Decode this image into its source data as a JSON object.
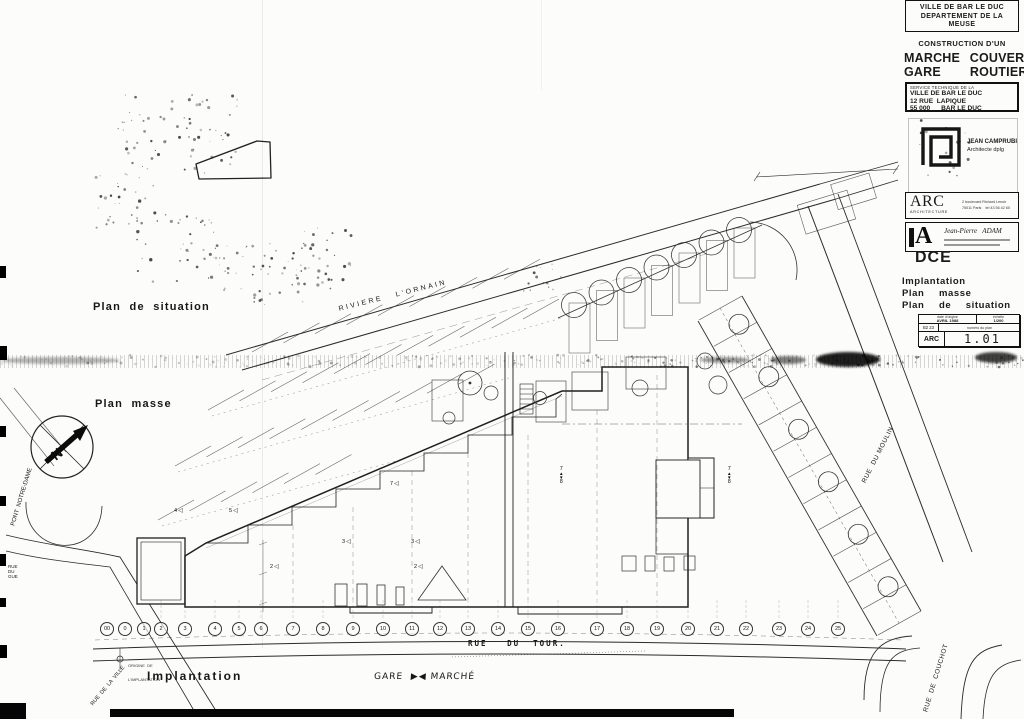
{
  "sheet_title_block": {
    "client_box": {
      "line1": "VILLE DE BAR LE DUC",
      "line2": "DEPARTEMENT DE LA",
      "line3": "MEUSE"
    },
    "construction_label": "CONSTRUCTION D'UN",
    "project_line1": "MARCHE COUVERT",
    "project_line2": "GARE   ROUTIERE",
    "service_box": {
      "line1": "SERVICE TECHNIQUE DE LA",
      "line2": "VILLE DE BAR LE DUC",
      "line3": "12 RUE  LAPIQUE",
      "line4": "55 000      BAR LE DUC"
    },
    "architect": {
      "name": "JEAN CAMPRUBI",
      "title": "Architecte  dplg",
      "addr1": "11 rue des Epargnes",
      "addr2": "55 160  Fresnes en Woevre",
      "addr3": "1 29 1 87 33 43"
    },
    "arc_agency": {
      "name": "ARC",
      "subtitle": "ARCHITECTURE",
      "addr1": "2 boulevard Richard Lenoir",
      "addr2": "75011 Paris    tel 43 56 42 60"
    },
    "adam_agency": {
      "logo_letter": "A",
      "name": "Jean-Pierre   ADAM"
    },
    "phase": "DCE",
    "content_title1": "Implantation",
    "content_title2": "Plan  masse",
    "content_title3": "Plan  de  situation",
    "info_table": {
      "date_label": "date d'origine",
      "date_value": "AVRIL 1988",
      "scale_label": "échelle",
      "scale_value": "1/200",
      "code": "B2 23",
      "number_label": "numéro du plan",
      "agency": "ARC",
      "plan_number": "1.01"
    }
  },
  "plan_labels": {
    "situation": "Plan  de  situation",
    "masse": "Plan  masse",
    "implantation": "Implantation",
    "gare_marche": "GARE  ▶◀ MARCHÉ",
    "origin_line1": "ORIGINE  DE",
    "origin_line2": "L'IMPLANTATION"
  },
  "streets": {
    "ornain": "RIVIERE   L'ORNAIN",
    "moulin": "RUE  DU MOULIN",
    "couchot": "RUE  DE  COUCHOT",
    "pont_notre_dame": "PONT  NOTRE-DAME",
    "rue_ville": "RUE  DE  LA  VILLE",
    "rue_gue": "RUE DU GUE",
    "rue_tour": "RUE   DU  TOUR."
  },
  "compass_letter": "N",
  "grid_markers": {
    "labels": [
      "00",
      "0",
      "1",
      "2",
      "3",
      "4",
      "5",
      "6",
      "7",
      "8",
      "9",
      "10",
      "11",
      "12",
      "13",
      "14",
      "15",
      "16",
      "17",
      "18",
      "19",
      "20",
      "21",
      "22",
      "23",
      "24",
      "25"
    ],
    "xs": [
      107,
      125,
      144,
      161,
      185,
      215,
      239,
      261,
      293,
      323,
      353,
      383,
      412,
      440,
      468,
      498,
      528,
      558,
      597,
      627,
      657,
      688,
      717,
      746,
      779,
      808,
      838
    ]
  },
  "level_markers": [
    {
      "x": 565,
      "y": 477,
      "top": "7",
      "bottom": "8",
      "kind": "v"
    },
    {
      "x": 733,
      "y": 477,
      "top": "7",
      "bottom": "8",
      "kind": "v"
    },
    {
      "x": 396,
      "y": 492,
      "top": "7",
      "bottom": "",
      "kind": "s"
    },
    {
      "x": 235,
      "y": 519,
      "top": "5",
      "bottom": "",
      "kind": "s"
    },
    {
      "x": 180,
      "y": 519,
      "top": "4",
      "bottom": "",
      "kind": "s"
    },
    {
      "x": 348,
      "y": 550,
      "top": "3",
      "bottom": "",
      "kind": "s"
    },
    {
      "x": 417,
      "y": 550,
      "top": "3",
      "bottom": "",
      "kind": "s"
    },
    {
      "x": 276,
      "y": 575,
      "top": "2",
      "bottom": "",
      "kind": "s"
    },
    {
      "x": 420,
      "y": 575,
      "top": "2",
      "bottom": "",
      "kind": "s"
    }
  ]
}
